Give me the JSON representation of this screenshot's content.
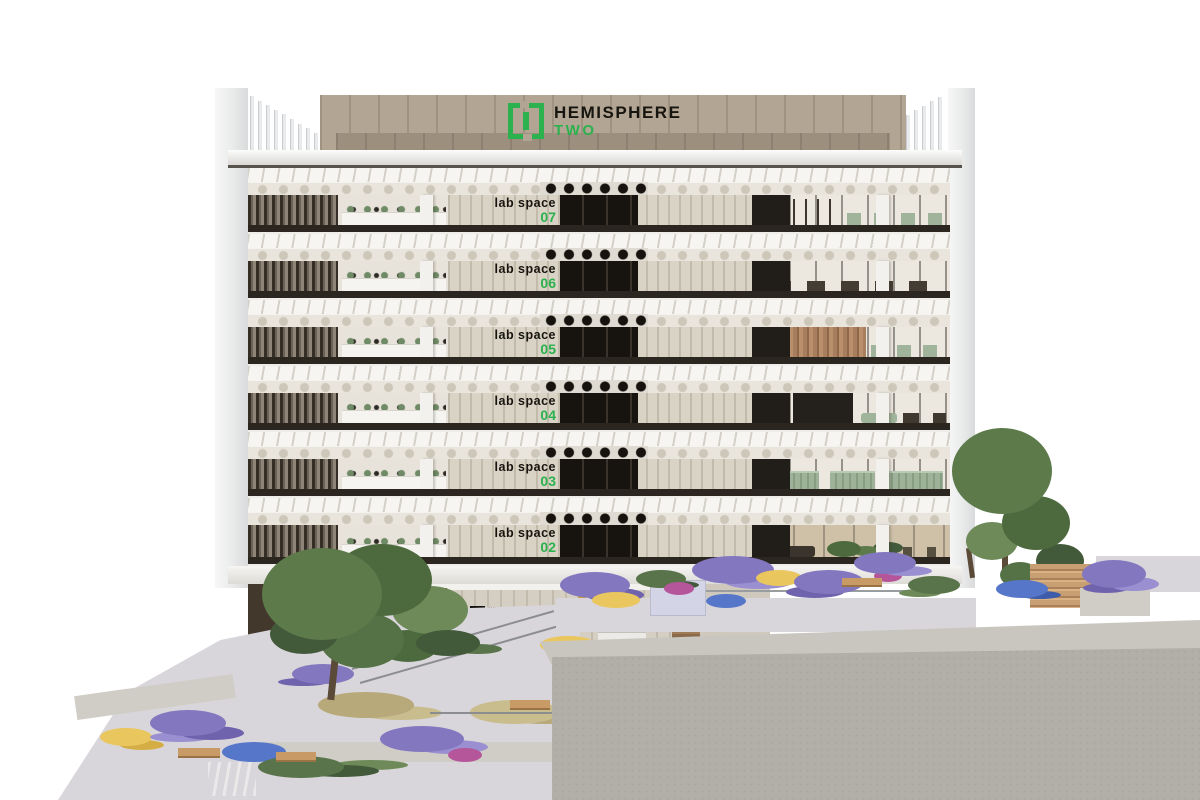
{
  "scene": {
    "description": "Architectural cutaway rendering of the Hemisphere Two laboratory building with landscaped terraces and robotics lobby"
  },
  "signage": {
    "main_sign": {
      "line1": "HEMISPHERE",
      "line2": "TWO"
    },
    "lobby_sign": {
      "line1": "HEMISPHERE",
      "line2": "TWO"
    },
    "crest": {
      "line1": "UNIVERSITY OF",
      "line2": "LIVERPOOL",
      "line3": "IN LONDON"
    }
  },
  "floors": [
    {
      "label": "lab space",
      "number": "07"
    },
    {
      "label": "lab space",
      "number": "06"
    },
    {
      "label": "lab space",
      "number": "05"
    },
    {
      "label": "lab space",
      "number": "04"
    },
    {
      "label": "lab space",
      "number": "03"
    },
    {
      "label": "lab space",
      "number": "02"
    }
  ],
  "colors": {
    "brand_green": "#2bb14d",
    "sign_band_tan": "#b2a593",
    "core_wall_beige": "#d9d3c6",
    "concrete_gray": "#b2afa8",
    "lavender": "#8377bf",
    "foliage_green": "#59744a",
    "sage_furniture": "#9fb49a"
  }
}
